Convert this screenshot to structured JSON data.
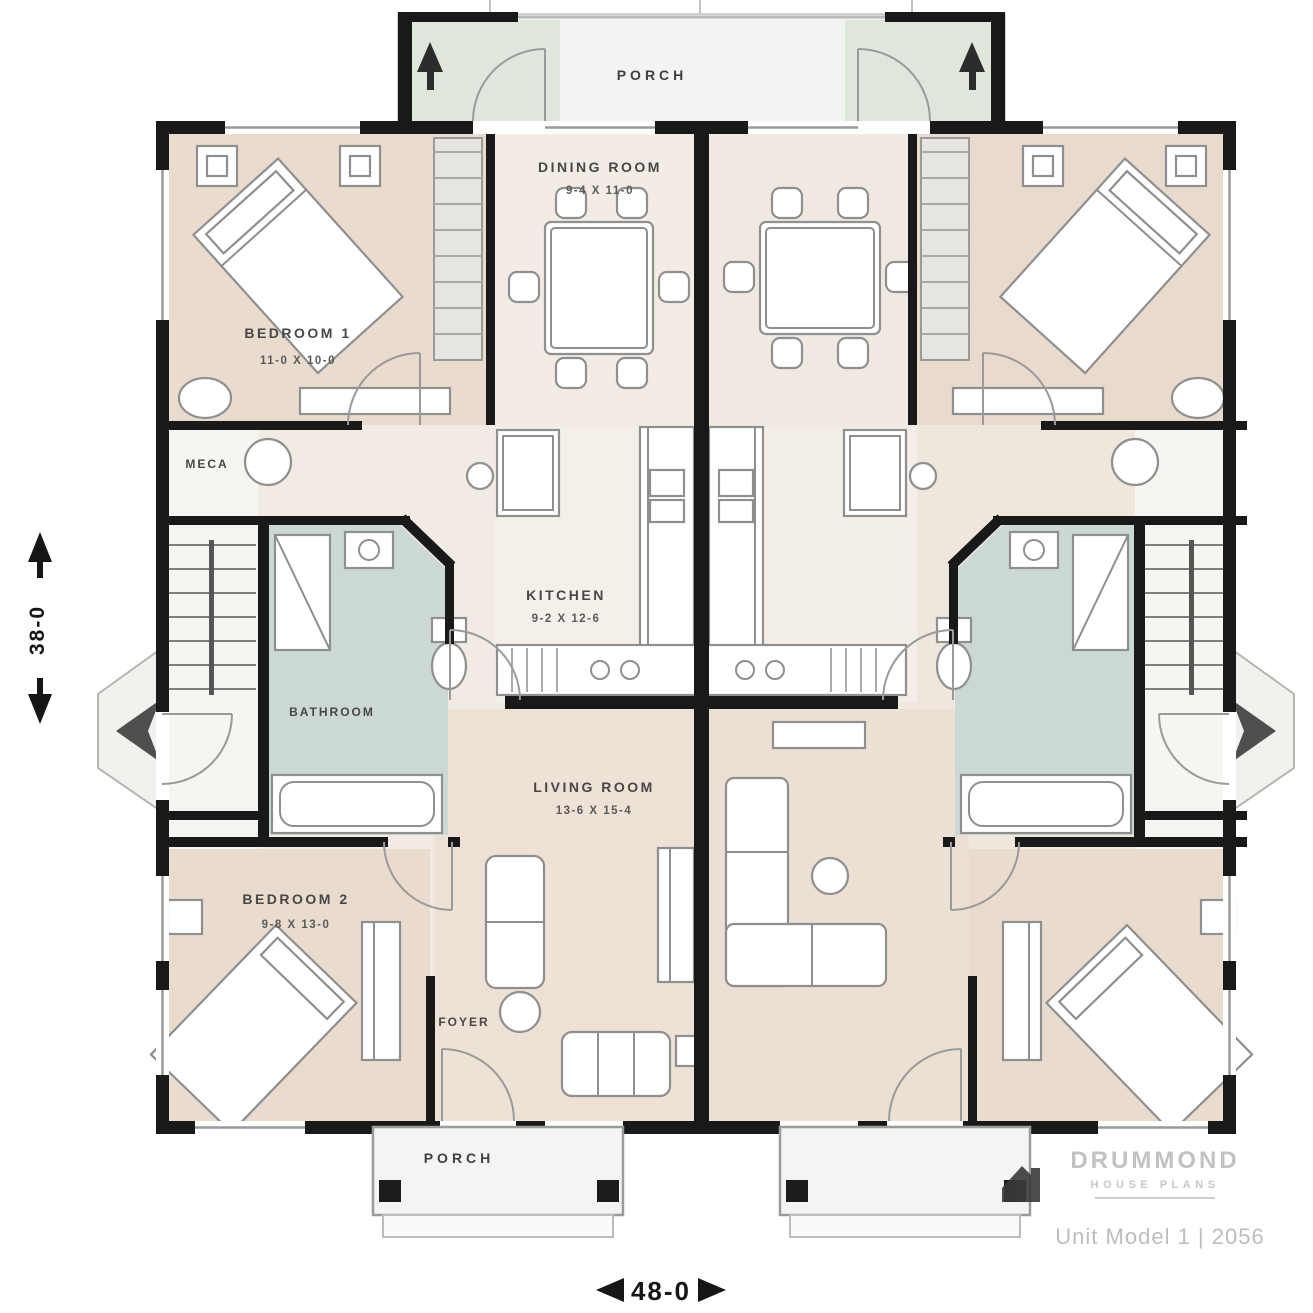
{
  "title": "Duplex first floor plan",
  "colors": {
    "wall": "#191919",
    "floor_base": "#f1ebe3",
    "floor_bedroom": "#e9dbcd",
    "floor_living": "#eee1d5",
    "bathroom": "#ccd8d6",
    "porch_green": "#dfe7dc",
    "furniture_stroke": "#8f8f8f",
    "label": "#474747",
    "watermark": "#bdbcba"
  },
  "labels": {
    "porch_top": "PORCH",
    "porch_bottom": "PORCH"
  },
  "rooms": {
    "bedroom1": {
      "name": "BEDROOM 1",
      "dims": "11-0 X 10-0"
    },
    "dining": {
      "name": "DINING ROOM",
      "dims": "9-4 X 11-0"
    },
    "kitchen": {
      "name": "KITCHEN",
      "dims": "9-2 X 12-6"
    },
    "bathroom": {
      "name": "BATHROOM"
    },
    "meca": {
      "name": "MECA"
    },
    "living": {
      "name": "LIVING ROOM",
      "dims": "13-6 X 15-4"
    },
    "bedroom2": {
      "name": "BEDROOM 2",
      "dims": "9-8 X 13-0"
    },
    "foyer": {
      "name": "FOYER"
    }
  },
  "dimensions": {
    "width_label": "48-0",
    "height_label": "38-0"
  },
  "watermark": {
    "brand_top": "DRUMMOND",
    "brand_bottom": "HOUSE PLANS",
    "plan_ref": "Unit Model 1 | 2056"
  }
}
